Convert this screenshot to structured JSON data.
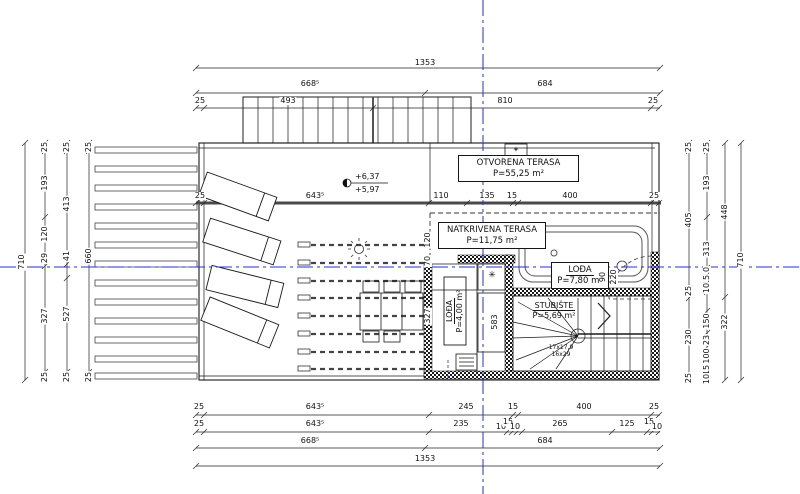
{
  "rooms": {
    "otvorena": {
      "name": "OTVORENA TERASA",
      "area": "P=55,25 m²"
    },
    "natkrivena": {
      "name": "NATKRIVENA TERASA",
      "area": "P=11,75 m²"
    },
    "lodja_a": {
      "name": "LOĐA",
      "area": "P=7,80 m²"
    },
    "lodja_b": {
      "name": "LOĐA",
      "area": "P=4,00 m²"
    },
    "stubiste": {
      "name": "STUBIŠTE",
      "area": "P=5,69 m²"
    }
  },
  "elevation": {
    "upper": "+6,37",
    "lower": "+5,97"
  },
  "stair_note": {
    "line1": "17x17,9",
    "line2": "16x29"
  },
  "symbols": {
    "fixture_star": "✳",
    "roof_vent": "✦"
  },
  "colors": {
    "centerline": "#2233cc",
    "line": "#1a1a1a"
  },
  "dims": [
    {
      "t": "1353",
      "x": 425,
      "y": 63,
      "r": 0
    },
    {
      "t": "668⁵",
      "x": 310,
      "y": 84,
      "r": 0
    },
    {
      "t": "684",
      "x": 545,
      "y": 84,
      "r": 0
    },
    {
      "t": "25",
      "x": 200,
      "y": 101,
      "r": 0
    },
    {
      "t": "493",
      "x": 288,
      "y": 101,
      "r": 0
    },
    {
      "t": "810",
      "x": 505,
      "y": 101,
      "r": 0
    },
    {
      "t": "25",
      "x": 653,
      "y": 101,
      "r": 0
    },
    {
      "t": "25",
      "x": 200,
      "y": 196,
      "r": 0
    },
    {
      "t": "643⁵",
      "x": 315,
      "y": 196,
      "r": 0
    },
    {
      "t": "110",
      "x": 441,
      "y": 196,
      "r": 0
    },
    {
      "t": "135",
      "x": 487,
      "y": 196,
      "r": 0
    },
    {
      "t": "15",
      "x": 512,
      "y": 196,
      "r": 0
    },
    {
      "t": "400",
      "x": 570,
      "y": 196,
      "r": 0
    },
    {
      "t": "25",
      "x": 654,
      "y": 196,
      "r": 0
    },
    {
      "t": "25",
      "x": 199,
      "y": 407,
      "r": 0
    },
    {
      "t": "643⁵",
      "x": 315,
      "y": 407,
      "r": 0
    },
    {
      "t": "245",
      "x": 466,
      "y": 407,
      "r": 0
    },
    {
      "t": "15",
      "x": 513,
      "y": 407,
      "r": 0
    },
    {
      "t": "400",
      "x": 584,
      "y": 407,
      "r": 0
    },
    {
      "t": "25",
      "x": 654,
      "y": 407,
      "r": 0
    },
    {
      "t": "25",
      "x": 199,
      "y": 424,
      "r": 0
    },
    {
      "t": "643⁵",
      "x": 315,
      "y": 424,
      "r": 0
    },
    {
      "t": "235",
      "x": 461,
      "y": 424,
      "r": 0
    },
    {
      "t": "10",
      "x": 501,
      "y": 427,
      "r": 0
    },
    {
      "t": "15",
      "x": 508,
      "y": 422,
      "r": 0
    },
    {
      "t": "10",
      "x": 515,
      "y": 427,
      "r": 0
    },
    {
      "t": "265",
      "x": 560,
      "y": 424,
      "r": 0
    },
    {
      "t": "125",
      "x": 627,
      "y": 424,
      "r": 0
    },
    {
      "t": "15",
      "x": 649,
      "y": 422,
      "r": 0
    },
    {
      "t": "10",
      "x": 657,
      "y": 427,
      "r": 0
    },
    {
      "t": "668⁵",
      "x": 310,
      "y": 441,
      "r": 0
    },
    {
      "t": "684",
      "x": 545,
      "y": 441,
      "r": 0
    },
    {
      "t": "1353",
      "x": 425,
      "y": 459,
      "r": 0
    },
    {
      "t": "710",
      "x": 22,
      "y": 262,
      "r": 1
    },
    {
      "t": "25",
      "x": 45,
      "y": 147,
      "r": 1
    },
    {
      "t": "193",
      "x": 45,
      "y": 183,
      "r": 1
    },
    {
      "t": "120",
      "x": 45,
      "y": 234,
      "r": 1
    },
    {
      "t": "29",
      "x": 45,
      "y": 258,
      "r": 1
    },
    {
      "t": "327",
      "x": 45,
      "y": 316,
      "r": 1
    },
    {
      "t": "25",
      "x": 45,
      "y": 377,
      "r": 1
    },
    {
      "t": "25",
      "x": 67,
      "y": 147,
      "r": 1
    },
    {
      "t": "413",
      "x": 67,
      "y": 204,
      "r": 1
    },
    {
      "t": "41",
      "x": 67,
      "y": 256,
      "r": 1
    },
    {
      "t": "527",
      "x": 67,
      "y": 314,
      "r": 1
    },
    {
      "t": "25",
      "x": 67,
      "y": 377,
      "r": 1
    },
    {
      "t": "25",
      "x": 89,
      "y": 147,
      "r": 1
    },
    {
      "t": "660",
      "x": 89,
      "y": 256,
      "r": 1
    },
    {
      "t": "25",
      "x": 89,
      "y": 377,
      "r": 1
    },
    {
      "t": "120",
      "x": 428,
      "y": 240,
      "r": 1
    },
    {
      "t": "70",
      "x": 428,
      "y": 261,
      "r": 1
    },
    {
      "t": "327",
      "x": 428,
      "y": 316,
      "r": 1
    },
    {
      "t": "25",
      "x": 689,
      "y": 147,
      "r": 1
    },
    {
      "t": "405",
      "x": 689,
      "y": 220,
      "r": 1
    },
    {
      "t": "25",
      "x": 689,
      "y": 291,
      "r": 1
    },
    {
      "t": "230",
      "x": 689,
      "y": 337,
      "r": 1
    },
    {
      "t": "25",
      "x": 689,
      "y": 378,
      "r": 1
    },
    {
      "t": "25",
      "x": 707,
      "y": 147,
      "r": 1
    },
    {
      "t": "193",
      "x": 707,
      "y": 183,
      "r": 1
    },
    {
      "t": "313",
      "x": 707,
      "y": 249,
      "r": 1
    },
    {
      "t": "10",
      "x": 707,
      "y": 272,
      "r": 1
    },
    {
      "t": "15",
      "x": 707,
      "y": 280,
      "r": 1
    },
    {
      "t": "10",
      "x": 707,
      "y": 288,
      "r": 1
    },
    {
      "t": "150",
      "x": 707,
      "y": 321,
      "r": 1
    },
    {
      "t": "23",
      "x": 707,
      "y": 340,
      "r": 1
    },
    {
      "t": "100",
      "x": 707,
      "y": 356,
      "r": 1
    },
    {
      "t": "15",
      "x": 707,
      "y": 370,
      "r": 1
    },
    {
      "t": "10",
      "x": 707,
      "y": 379,
      "r": 1
    },
    {
      "t": "448",
      "x": 725,
      "y": 212,
      "r": 1
    },
    {
      "t": "322",
      "x": 725,
      "y": 322,
      "r": 1
    },
    {
      "t": "710",
      "x": 741,
      "y": 260,
      "r": 1
    },
    {
      "t": "90",
      "x": 603,
      "y": 277,
      "r": 1
    },
    {
      "t": "220",
      "x": 614,
      "y": 277,
      "r": 1
    },
    {
      "t": "583",
      "x": 495,
      "y": 322,
      "r": 1
    }
  ]
}
